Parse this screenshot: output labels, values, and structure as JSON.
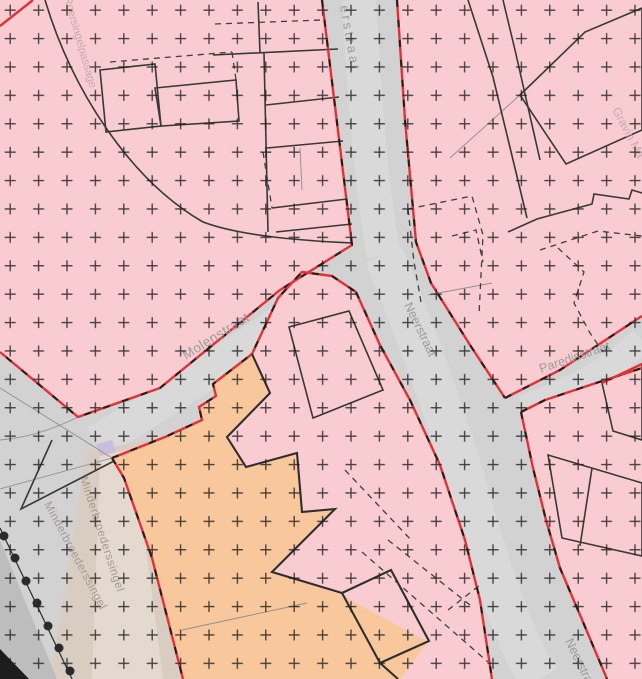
{
  "map": {
    "kind": "zoning-map",
    "labels": {
      "roersingelpassage": "Roersingelpassage",
      "street_top_partial": "erstraat",
      "molenstraat": "Molenstraat",
      "neerstraat_east": "Neerstraat",
      "neerstraat_south": "Neerstraat",
      "paredisstraat": "Paredisstraat",
      "gravin_partial": "Gravin Ma",
      "minderbroederssingel_1": "Minderbroederssingel",
      "minderbroederssingel_2": "Minderbroederssingel"
    },
    "colors": {
      "road_gray": "#d2d2d3",
      "zone_pink": "#f8ccd1",
      "zone_orange": "#f9c79c",
      "building_orange": "#f4b98d",
      "building_brown": "#c1897a",
      "boundary_red": "#e03236",
      "tan_road": "#d9cdc2",
      "tan_light": "#e3d9cf",
      "gray_triangle": "#bdbdbd",
      "corner_black": "#1d1d1d",
      "lavender": "#c9bedc",
      "cross_black": "#1f1f1f"
    }
  }
}
